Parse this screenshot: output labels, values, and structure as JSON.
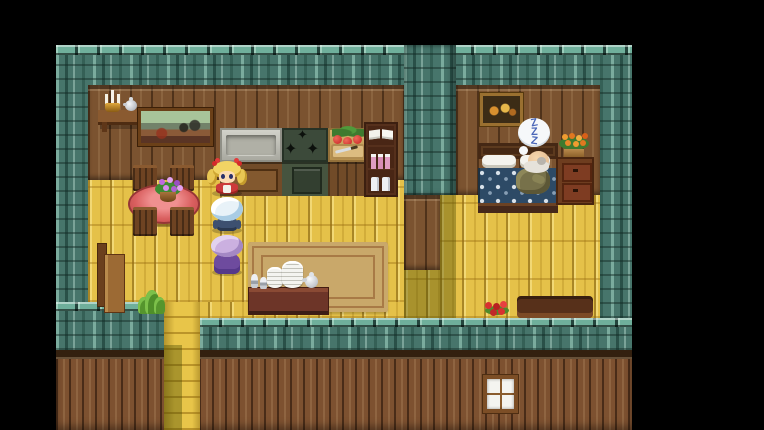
{
  "scene": {
    "caption": "RPG house interior: kitchen and dining room on the left, bedroom with a sleeping old man on the right, three party members stacked near the dining table",
    "sleep_bubble": {
      "z_top": "Z",
      "z_mid": "Z",
      "z_bottom": "Z"
    },
    "icons": {
      "stove_burner": "✦"
    },
    "colors": {
      "letterbox": "#000000",
      "roof_shingle": "#47756b",
      "roof_cap": "#6faf9b",
      "floor_plank": "#e5c149",
      "interior_wall": "#7b5330",
      "exterior_wall": "#7d5130",
      "rug": "#c9a86a",
      "tablecloth": "#d95f5f",
      "bed_blanket": "#2d4a66",
      "bubble_text": "#4a66b8",
      "shadow_olive": "rgba(68,70,0,0.38)"
    },
    "entities": [
      "roof",
      "kitchen-counter",
      "sink",
      "stove",
      "prep-counter",
      "bookshelf",
      "wall-shelf",
      "candelabra",
      "teapot",
      "landscape-painting",
      "dining-table",
      "flower-basket",
      "chairs",
      "heroine-blonde",
      "party-member-blue-hair",
      "party-member-purple-hair",
      "bench",
      "house-plant",
      "rug",
      "dish-table",
      "plate-stacks",
      "goblets",
      "exit-stairs",
      "framed-picture",
      "bed",
      "sleeping-old-man",
      "sleep-bubble",
      "flower-pot",
      "dresser",
      "red-flowers",
      "doorstep",
      "exterior-wall",
      "window"
    ]
  }
}
